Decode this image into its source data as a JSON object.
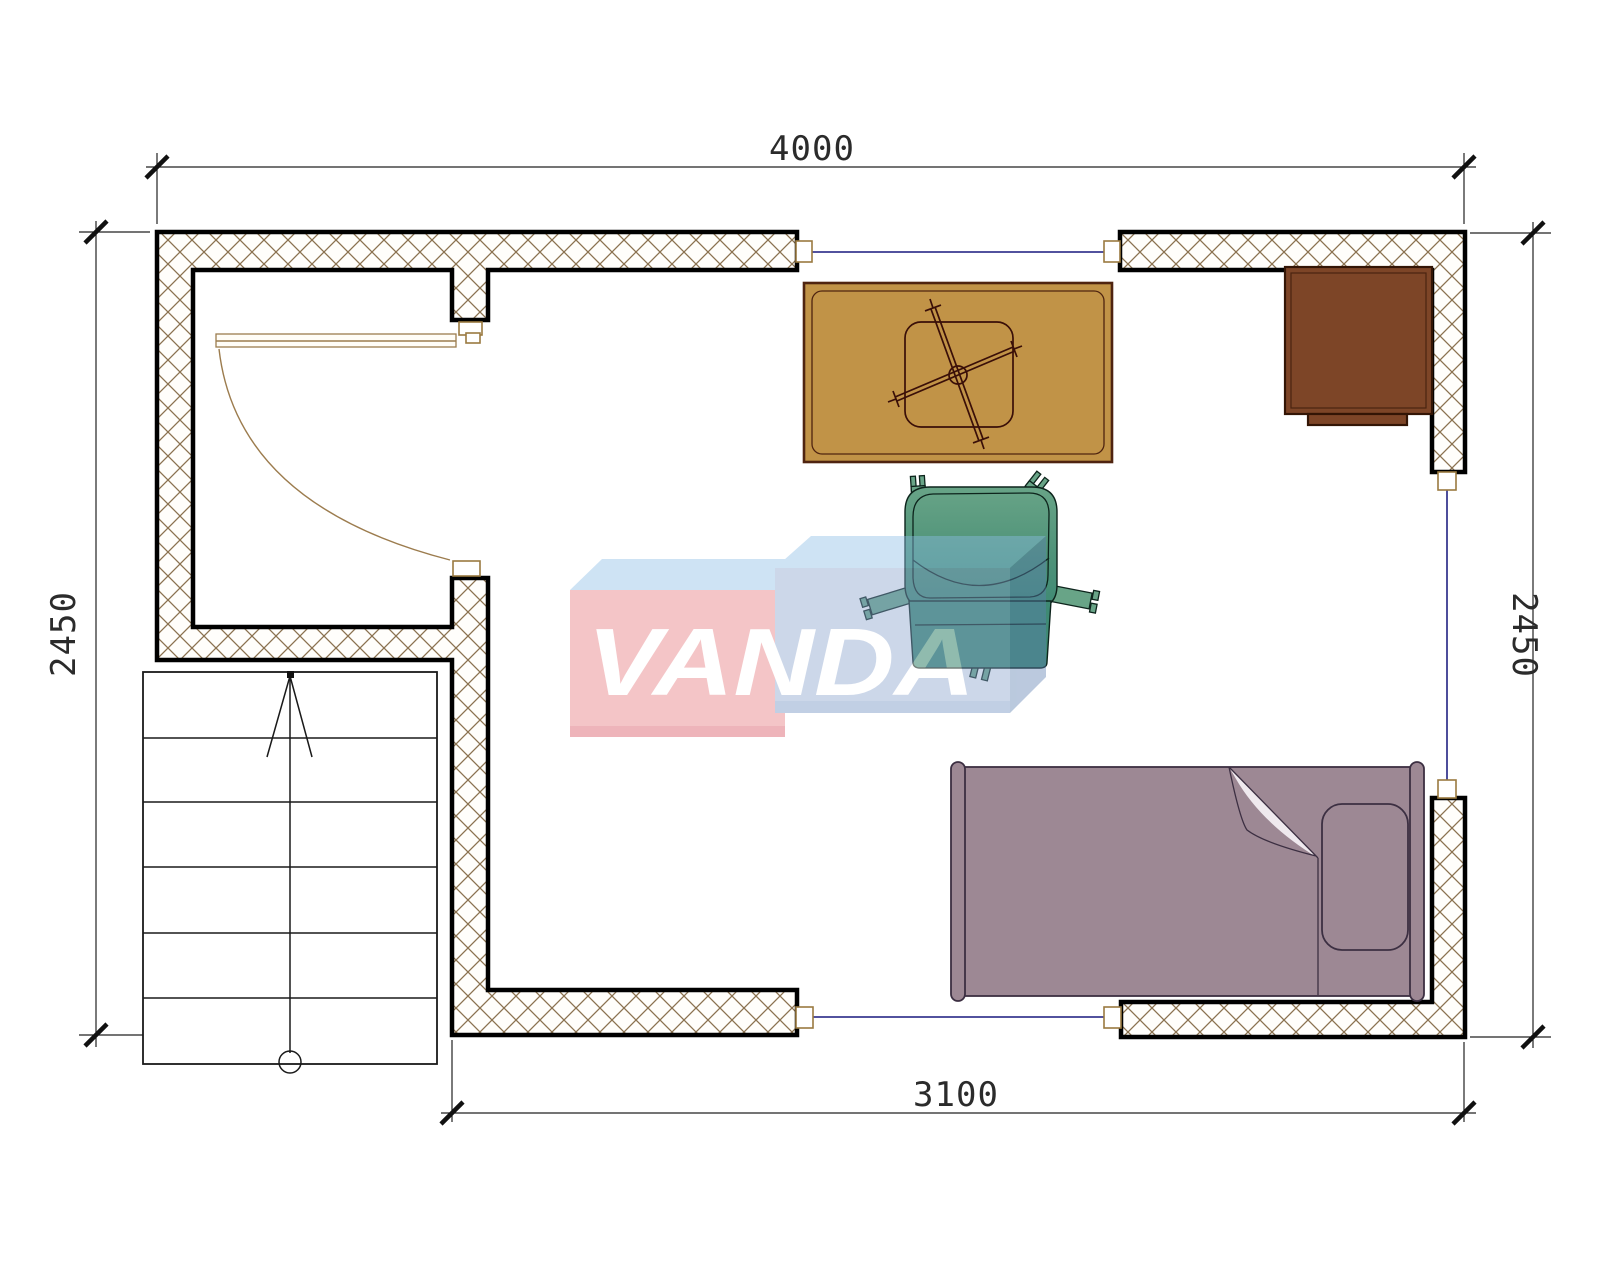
{
  "page": {
    "type": "architectural-floor-plan-drawing"
  },
  "dimensions": {
    "top": "4000",
    "bottom": "3100",
    "left": "2450",
    "right": "2450"
  },
  "watermark": {
    "text": "VANDA"
  },
  "elements": {
    "door": "swing-door",
    "stairs": "staircase-with-up-arrow",
    "windows_count": 3,
    "furniture": [
      "table-with-ceiling-fan-symbol",
      "armchair",
      "single-bed-with-pillow",
      "cabinet"
    ]
  },
  "colors": {
    "wall_hatch": "#8b7250",
    "wall_outline": "#000000",
    "window_glass": "#3a3a90",
    "window_frame": "#9a7a40",
    "door": "#9c7c4e",
    "dim_line": "#222222",
    "dim_text": "#2b2b2b",
    "stairs_line": "#1a1a1a",
    "table": "#c19347",
    "table_outline": "#4f2410",
    "chair": "#4f9379",
    "chair_light": "#68a487",
    "chair_dark": "#3f8a74",
    "bed": "#9d8894",
    "bed_outline": "#3c2f42",
    "cabinet": "#7d4527",
    "cabinet_outline": "#331505",
    "wm_pink": "#e7777c",
    "wm_blue_top": "#8cbee7",
    "wm_lavender": "#88a2cd",
    "wm_side": "#5c7fb0",
    "wm_text": "#ffffff"
  }
}
